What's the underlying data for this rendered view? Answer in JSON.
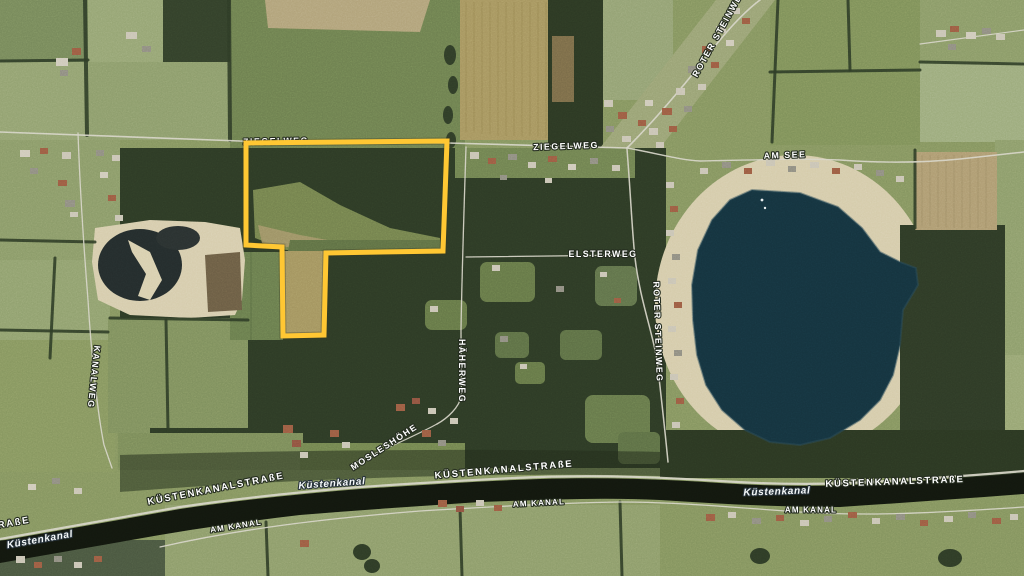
{
  "map": {
    "view_type": "satellite",
    "parcel": {
      "outline_color": "#FFC733"
    },
    "water": {
      "lake_color": "#15333E",
      "canal_color": "#12170E"
    },
    "label_style": {
      "fill": "#FFFFFF",
      "halo": "#242C1F"
    },
    "labels": {
      "ziegelweg_west": "ZIEGELWEG",
      "ziegelweg_east": "ZIEGELWEG",
      "am_see": "AM SEE",
      "roter_steinweg_north": "ROTER STEINWEG",
      "roter_steinweg_mid": "ROTER STEINWEG",
      "elsterweg": "ELSTERWEG",
      "haeherweg": "HÄHERWEG",
      "kanalweg": "KANALWEG",
      "mosleshoehe": "MOSLESHÖHE",
      "kuestenkanalstrasse_west": "KÜSTENKANALSTRAßE",
      "kuestenkanalstrasse_center": "KÜSTENKANALSTRAßE",
      "kuestenkanalstrasse_east": "KÜSTENKANALSTRAßE",
      "kuestenkanalstrasse_partial": "RAßE",
      "am_kanal_west": "AM KANAL",
      "am_kanal_center": "AM KANAL",
      "am_kanal_east": "AM KANAL",
      "kuestenkanal_west": "Küstenkanal",
      "kuestenkanal_center": "Küstenkanal",
      "kuestenkanal_east": "Küstenkanal"
    }
  }
}
